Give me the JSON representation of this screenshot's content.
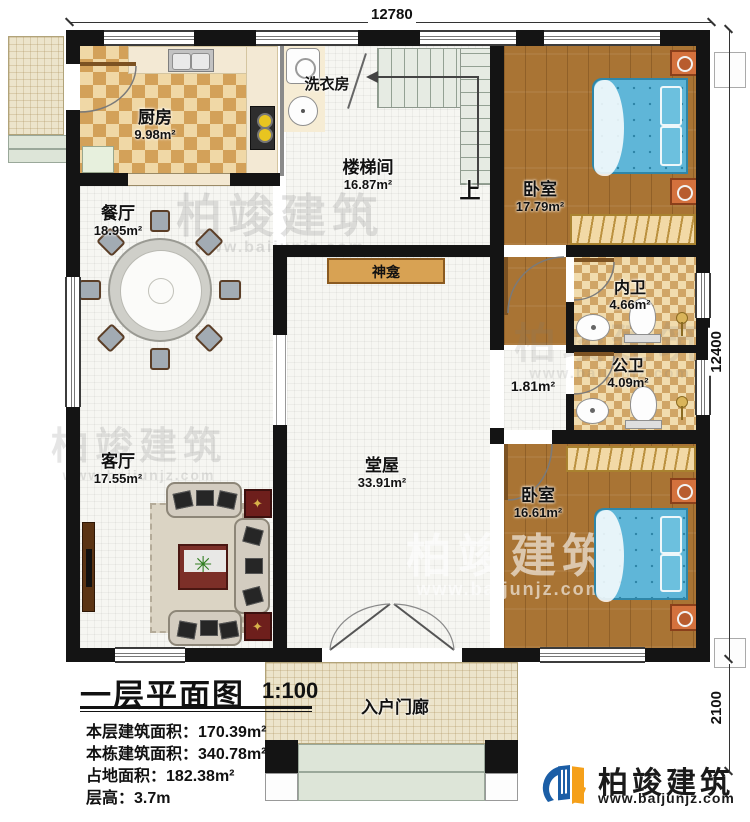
{
  "dimensions": {
    "top": "12780",
    "right": "12400",
    "porch_depth": "2100"
  },
  "rooms": {
    "kitchen": {
      "name": "厨房",
      "area": "9.98m²"
    },
    "laundry": {
      "name": "洗衣房"
    },
    "stairwell": {
      "name": "楼梯间",
      "area": "16.87m²"
    },
    "dining": {
      "name": "餐厅",
      "area": "18.95m²"
    },
    "bedroom1": {
      "name": "卧室",
      "area": "17.79m²"
    },
    "bath_private": {
      "name": "内卫",
      "area": "4.66m²"
    },
    "bath_public": {
      "name": "公卫",
      "area": "4.09m²"
    },
    "corridor": {
      "area": "1.81m²"
    },
    "shrine": {
      "name": "神龛"
    },
    "hall": {
      "name": "堂屋",
      "area": "33.91m²"
    },
    "living": {
      "name": "客厅",
      "area": "17.55m²"
    },
    "bedroom2": {
      "name": "卧室",
      "area": "16.61m²"
    },
    "porch": {
      "name": "入户门廊"
    }
  },
  "stair_up_label": "上",
  "title_block": {
    "title": "一层平面图",
    "scale": "1:100",
    "stats": [
      {
        "label": "本层建筑面积：",
        "value": "170.39m²"
      },
      {
        "label": "本栋建筑面积：",
        "value": "340.78m²"
      },
      {
        "label": "占地面积：",
        "value": "182.38m²"
      },
      {
        "label": "层高：",
        "value": "3.7m"
      }
    ]
  },
  "brand": {
    "name": "柏竣建筑",
    "url": "www.baijunjz.com",
    "blue": "#1b5ea6",
    "orange": "#f5a01a"
  },
  "watermark": {
    "name": "柏竣建筑",
    "url": "www.baijunjz.com"
  }
}
